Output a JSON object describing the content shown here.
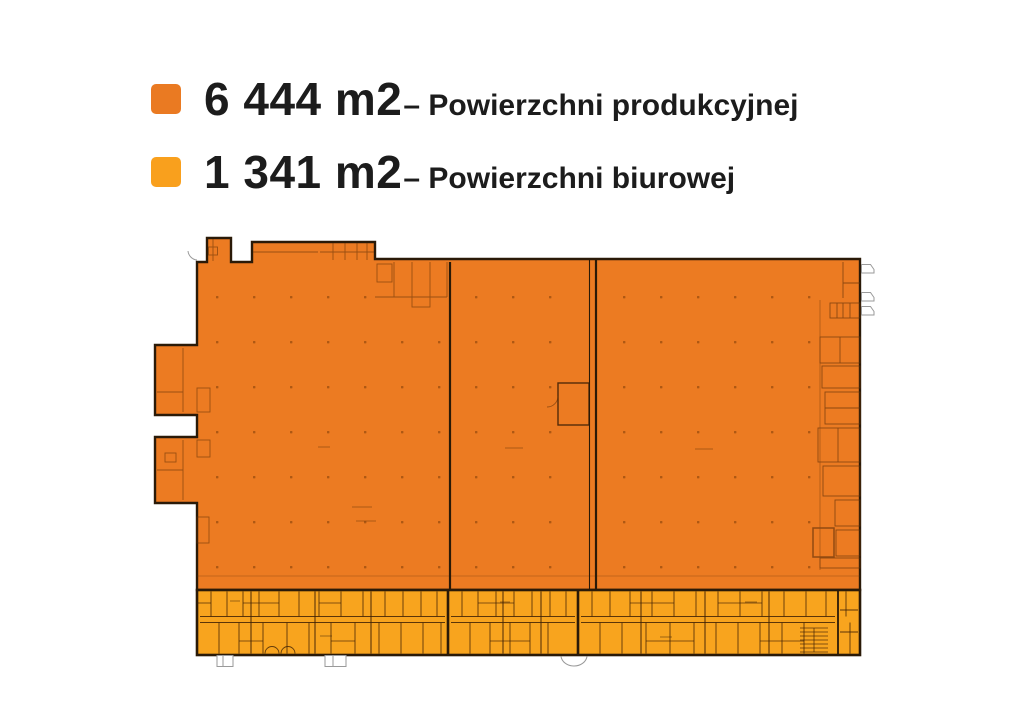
{
  "legend": {
    "items": [
      {
        "area": "6 444 m2",
        "label": "– Powierzchni produkcyjnej",
        "color": "#EA7A22"
      },
      {
        "area": "1 341 m2",
        "label": "– Powierzchni biurowej",
        "color": "#F9A01D"
      }
    ]
  },
  "floor_plan": {
    "production_fill": "#EC7B22",
    "office_fill": "#F8A41E",
    "outline_color": "#2A1A08",
    "production_detail_color": "#653208",
    "office_detail_color": "#3F2205",
    "symbol_gray": "#9A9A9A"
  }
}
